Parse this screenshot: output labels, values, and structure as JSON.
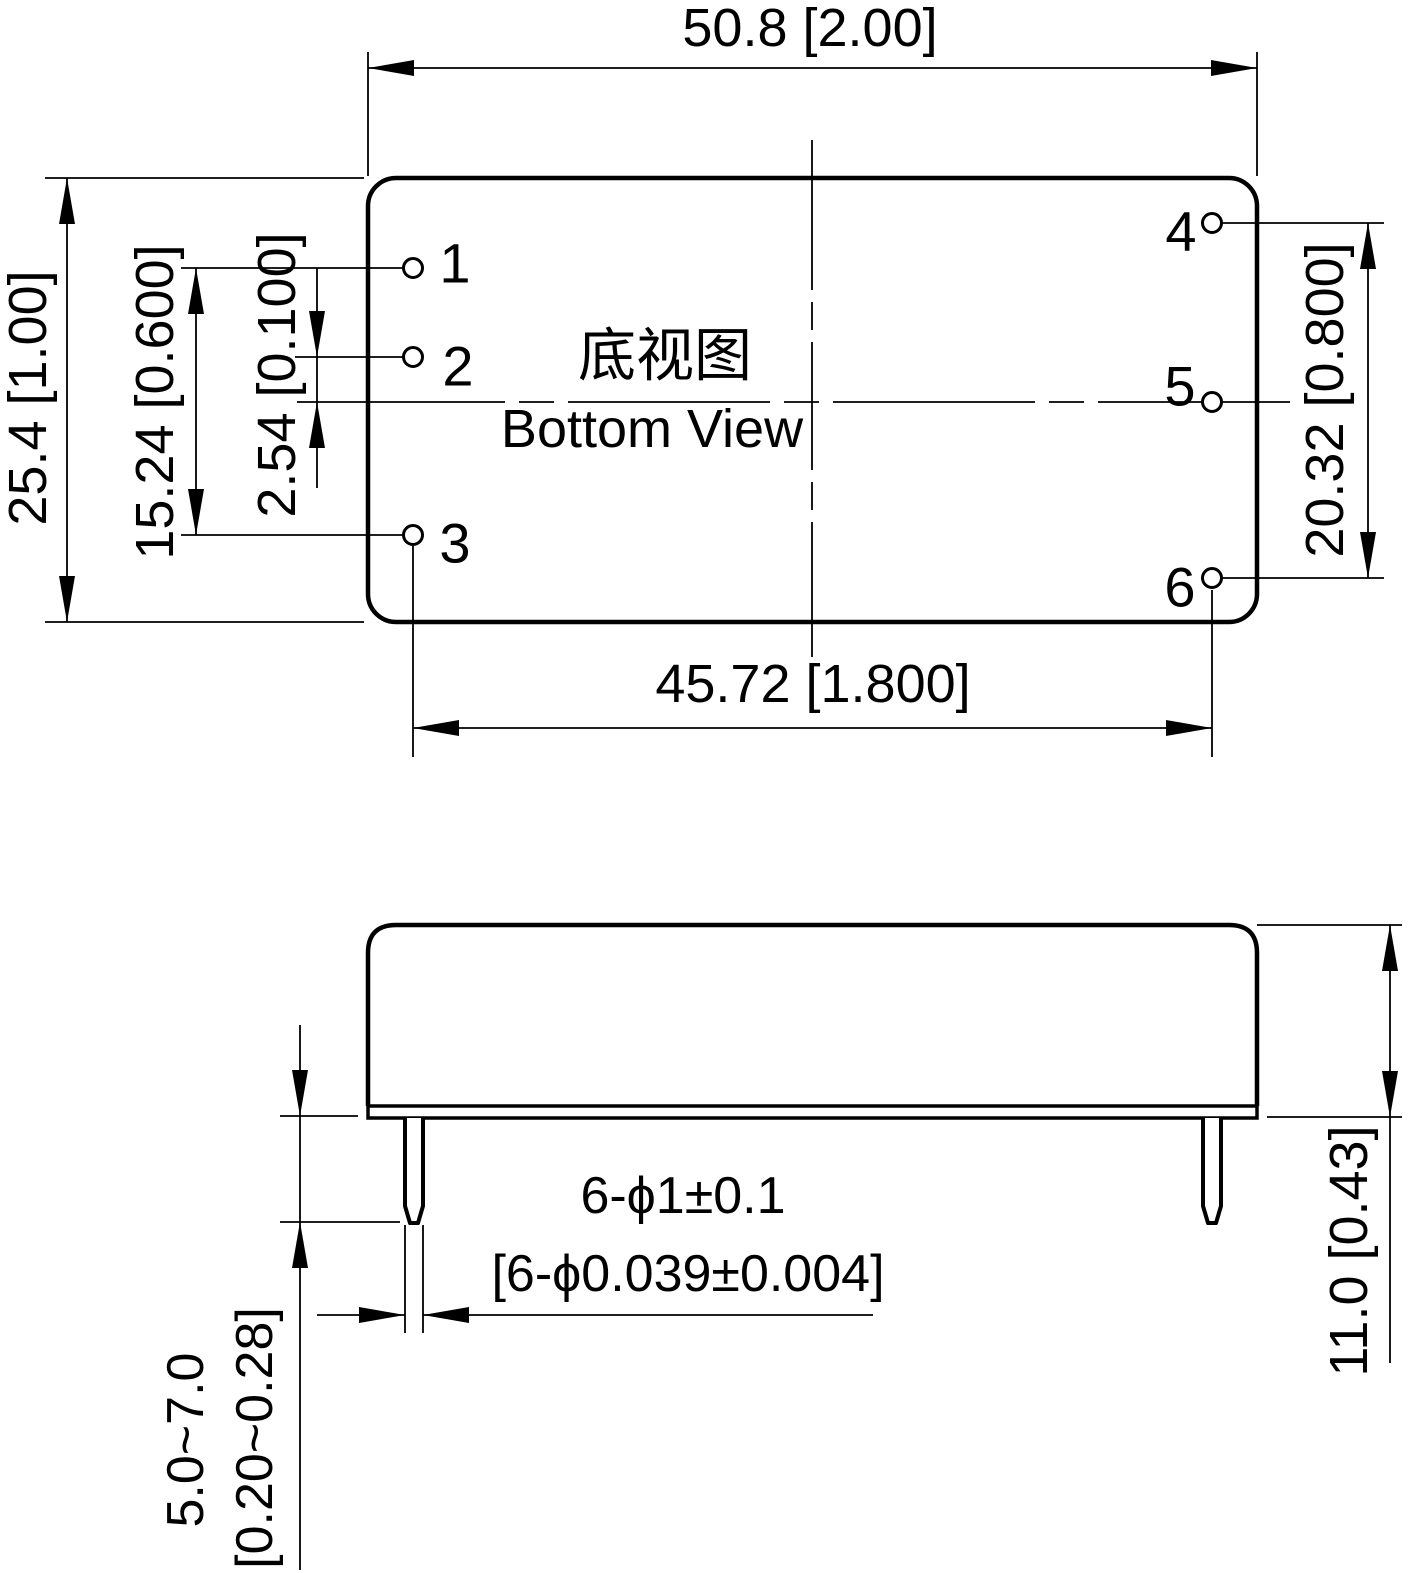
{
  "canvas": {
    "background": "#ffffff",
    "ink": "#000000"
  },
  "top_view": {
    "title_cn": "底视图",
    "title_en": "Bottom View",
    "pin_labels": [
      "1",
      "2",
      "3",
      "4",
      "5",
      "6"
    ],
    "dim_overall_width": "50.8 [2.00]",
    "dim_overall_height": "25.4 [1.00]",
    "dim_left_pin_span": "15.24 [0.600]",
    "dim_pin2_to_center": "2.54 [0.100]",
    "dim_right_pin_span": "20.32 [0.800]",
    "dim_pin_column_span": "45.72 [1.800]"
  },
  "side_view": {
    "dim_pin_dia_mm": "6-ϕ1±0.1",
    "dim_pin_dia_inch": "[6-ϕ0.039±0.004]",
    "dim_pin_len_mm": "5.0~7.0",
    "dim_pin_len_inch": "[0.20~0.28]",
    "dim_height": "11.0 [0.43]"
  }
}
